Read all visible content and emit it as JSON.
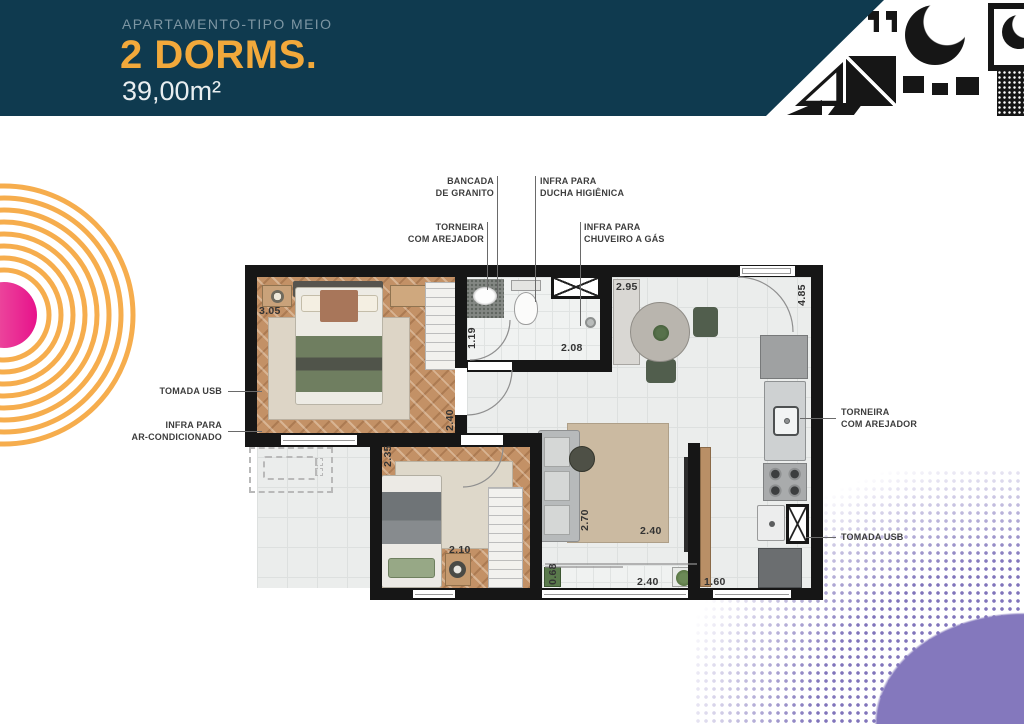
{
  "header": {
    "subtitle": "APARTAMENTO-TIPO MEIO",
    "title": "2 DORMS.",
    "area": "39,00m²"
  },
  "colors": {
    "navy": "#0F3A4F",
    "accent_yellow": "#F2A93B",
    "ring_orange": "#F6AD4D",
    "dot_pink": "#E7128B",
    "halftone_purple": "#8074BB"
  },
  "callouts": {
    "bancada_granito": "BANCADA\nDE GRANITO",
    "infra_ducha": "INFRA PARA\nDUCHA HIGIÊNICA",
    "torneira_arejador_top": "TORNEIRA\nCOM AREJADOR",
    "infra_chuveiro_gas": "INFRA PARA\nCHUVEIRO A GÁS",
    "tomada_usb_left": "TOMADA USB",
    "infra_ar_condicionado": "INFRA PARA\nAR-CONDICIONADO",
    "torneira_arejador_right": "TORNEIRA\nCOM AREJADOR",
    "tomada_usb_right": "TOMADA USB"
  },
  "measurements": {
    "bedroom1_width": "3.05",
    "bedroom1_door": "2.40",
    "bath_width": "1.19",
    "bath_length": "2.08",
    "dining_width": "2.95",
    "right_height": "4.85",
    "bedroom2_height": "2.35",
    "bedroom2_width": "2.10",
    "living_depth": "2.70",
    "living_width": "2.40",
    "balcony_depth": "0.68",
    "balcony_width": "2.40",
    "kitchen_width": "1.60"
  }
}
